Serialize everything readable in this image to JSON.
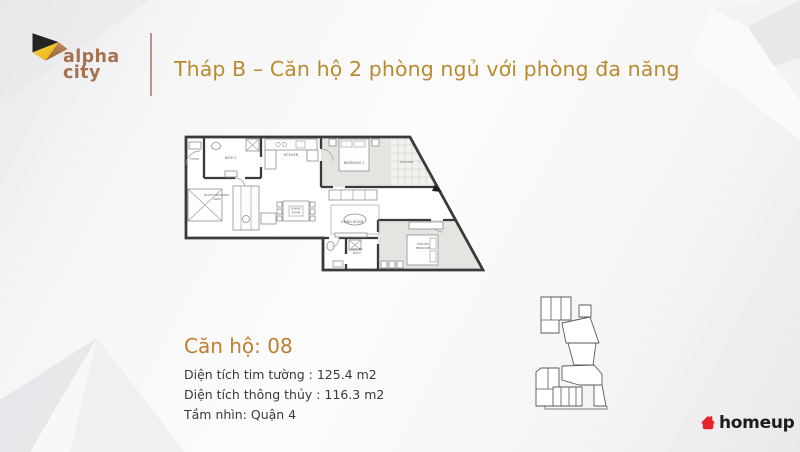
{
  "brand": {
    "logo_line1": "alpha",
    "logo_line2": "city"
  },
  "header": {
    "title": "Tháp B – Căn hộ 2 phòng ngủ với phòng đa năng"
  },
  "unit_info": {
    "title": "Căn hộ: 08",
    "line1": "Diện tích tim tường : 125.4 m2",
    "line2": "Diện tích thông thủy : 116.3 m2",
    "line3": "Tầm nhìn: Quận 4"
  },
  "floorplan": {
    "rooms": {
      "foyer": "FOYER",
      "bath1": "BATH 1",
      "kitchen": "KITCHEN",
      "bedroom1": "BEDROOM 1",
      "balcony": "BALCONY",
      "multifunctional_1": "MULTIFUNCTIONAL",
      "multifunctional_2": "AREA",
      "dining_1": "DINING",
      "dining_2": "ROOM",
      "living": "LIVING ROOM",
      "master_bath_1": "MASTER",
      "master_bath_2": "BATH",
      "master_bedroom_1": "MASTER",
      "master_bedroom_2": "BEDROOM"
    }
  },
  "footer": {
    "brand": "homeup"
  },
  "colors": {
    "title_gold": "#B98A2E",
    "unit_title_gold": "#C07E2E",
    "body_text": "#3A3A3A",
    "logo_brown_text": "#A5714E",
    "logo_black": "#242424",
    "logo_yellow": "#EFBE1C",
    "logo_copper": "#B0794A",
    "divider_brown": "#AB8474",
    "wall_dark": "#3A3A3A",
    "homeup_red": "#E5232A",
    "homeup_text": "#1C1C1C",
    "keyplan_highlight": "#161616"
  }
}
